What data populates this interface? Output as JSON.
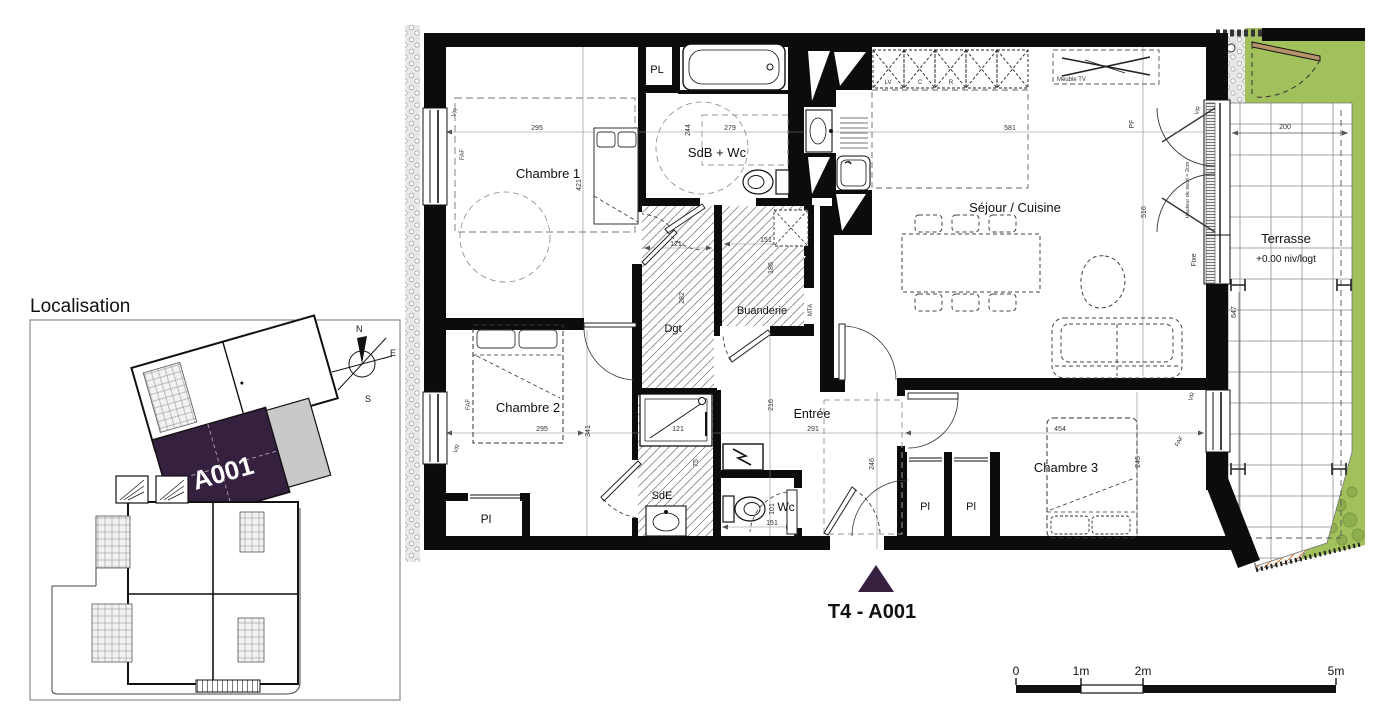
{
  "colors": {
    "accent_purple": "#362040",
    "grass_green": "#a2c05c",
    "grass_dark": "#7a9a42",
    "wall_black": "#0c0c0c",
    "slope_orange": "#c8824a",
    "balcony_gray": "#c9c9c9"
  },
  "localisation": {
    "title": "Localisation",
    "unit_label": "A001",
    "compass": {
      "north": "N",
      "east": "E",
      "south": "S",
      "west": "O"
    }
  },
  "plan": {
    "unit_title": "T4 - A001",
    "rooms": {
      "chambre1": {
        "label": "Chambre 1",
        "dim_w": "295",
        "dim_h": "421"
      },
      "pl_haut": {
        "label": "PL"
      },
      "sdb": {
        "label": "SdB + Wc",
        "dim_h": "244",
        "dim_w": "279"
      },
      "sejour": {
        "label": "Séjour / Cuisine",
        "dim_w": "581",
        "dim_h": "516"
      },
      "dgt": {
        "label": "Dgt",
        "dim_w": "121",
        "dim_h": "282"
      },
      "buanderie": {
        "label": "Buanderie",
        "dim_w": "151",
        "dim_h": "186"
      },
      "chambre2": {
        "label": "Chambre 2",
        "dim_w": "295",
        "dim_h": "341"
      },
      "pl_bas": {
        "label": "Pl"
      },
      "sde": {
        "label": "SdE",
        "dim_w": "121",
        "dim_door": "75"
      },
      "wc": {
        "label": "Wc",
        "dim_h": "101",
        "dim_w": "151"
      },
      "entree": {
        "label": "Entrée",
        "dim_w": "291",
        "dim_v": "246",
        "dim_left": "216"
      },
      "chambre3": {
        "label": "Chambre 3",
        "dim_w": "454",
        "dim_h": "245"
      },
      "pl3a": {
        "label": "Pl"
      },
      "pl3b": {
        "label": "Pl"
      },
      "terrasse": {
        "label": "Terrasse",
        "level": "+0.00 niv/logt",
        "dim_w": "200",
        "dim_h": "647"
      }
    },
    "annotations": {
      "vr": "VR",
      "faf": "FAF",
      "pf": "PF",
      "mta": "MTA",
      "fixe": "Fixe",
      "seuil": "Hauteur de seuil = 2cm",
      "meuble_tv": "Meuble TV",
      "kitchen_lv": "LV",
      "kitchen_c": "C",
      "kitchen_r": "R"
    },
    "scale_bar": {
      "t0": "0",
      "t1": "1m",
      "t2": "2m",
      "t5": "5m"
    }
  }
}
